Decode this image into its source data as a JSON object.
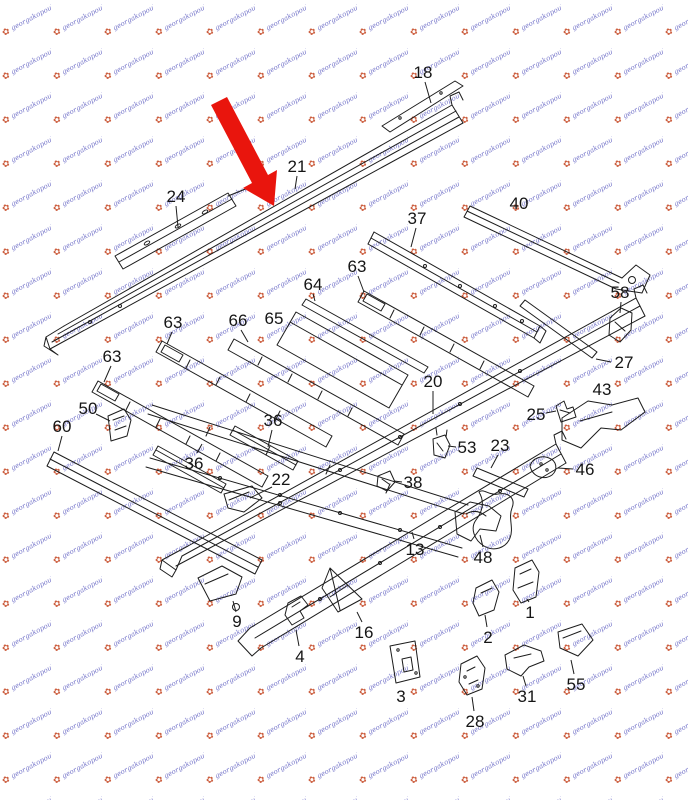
{
  "watermark": {
    "text": "georgakopoulos",
    "logo_glyph": "✿",
    "text_color": "#5a5ac0",
    "logo_color": "#c8502e"
  },
  "arrow": {
    "color": "#e9150d",
    "target_part": "21"
  },
  "diagram": {
    "line_color": "#1c1c1c",
    "label_color": "#151515",
    "parts": [
      {
        "label": "18",
        "x": 423,
        "y": 72,
        "leader": [
          425,
          82,
          431,
          103
        ]
      },
      {
        "label": "21",
        "x": 297,
        "y": 166,
        "leader": [
          297,
          176,
          295,
          189
        ]
      },
      {
        "label": "24",
        "x": 176,
        "y": 196,
        "leader": [
          176,
          206,
          178,
          227
        ]
      },
      {
        "label": "37",
        "x": 417,
        "y": 218,
        "leader": [
          416,
          228,
          411,
          247
        ]
      },
      {
        "label": "40",
        "x": 519,
        "y": 203,
        "leader": null
      },
      {
        "label": "58",
        "x": 620,
        "y": 292,
        "leader": [
          621,
          302,
          620,
          313
        ]
      },
      {
        "label": "63",
        "x": 173,
        "y": 322,
        "leader": [
          172,
          332,
          167,
          344
        ]
      },
      {
        "label": "63",
        "x": 112,
        "y": 356,
        "leader": [
          111,
          366,
          104,
          382
        ]
      },
      {
        "label": "63",
        "x": 357,
        "y": 266,
        "leader": [
          358,
          276,
          364,
          292
        ]
      },
      {
        "label": "64",
        "x": 313,
        "y": 284,
        "leader": [
          313,
          294,
          315,
          301
        ]
      },
      {
        "label": "65",
        "x": 274,
        "y": 318,
        "leader": null
      },
      {
        "label": "66",
        "x": 238,
        "y": 320,
        "leader": [
          241,
          330,
          248,
          342
        ]
      },
      {
        "label": "20",
        "x": 433,
        "y": 381,
        "leader": [
          433,
          391,
          433,
          414
        ]
      },
      {
        "label": "27",
        "x": 624,
        "y": 362,
        "leader": [
          611,
          362,
          596,
          359
        ]
      },
      {
        "label": "43",
        "x": 602,
        "y": 389,
        "leader": null
      },
      {
        "label": "25",
        "x": 536,
        "y": 414,
        "leader": [
          546,
          413,
          556,
          411
        ]
      },
      {
        "label": "23",
        "x": 500,
        "y": 445,
        "leader": [
          498,
          455,
          491,
          468
        ]
      },
      {
        "label": "53",
        "x": 467,
        "y": 447,
        "leader": [
          456,
          447,
          448,
          446
        ]
      },
      {
        "label": "46",
        "x": 585,
        "y": 469,
        "leader": [
          573,
          469,
          558,
          468
        ]
      },
      {
        "label": "38",
        "x": 413,
        "y": 482,
        "leader": [
          402,
          482,
          394,
          481
        ]
      },
      {
        "label": "36",
        "x": 273,
        "y": 420,
        "leader": [
          272,
          430,
          268,
          447
        ]
      },
      {
        "label": "36",
        "x": 194,
        "y": 463,
        "leader": [
          197,
          453,
          202,
          444
        ]
      },
      {
        "label": "22",
        "x": 281,
        "y": 479,
        "leader": [
          272,
          487,
          250,
          498
        ]
      },
      {
        "label": "50",
        "x": 88,
        "y": 408,
        "leader": [
          96,
          414,
          110,
          421
        ]
      },
      {
        "label": "60",
        "x": 62,
        "y": 426,
        "leader": [
          62,
          436,
          58,
          451
        ]
      },
      {
        "label": "13",
        "x": 415,
        "y": 549,
        "leader": [
          414,
          539,
          412,
          532
        ]
      },
      {
        "label": "48",
        "x": 483,
        "y": 557,
        "leader": [
          483,
          547,
          480,
          535
        ]
      },
      {
        "label": "9",
        "x": 237,
        "y": 621,
        "leader": [
          236,
          612,
          233,
          601
        ]
      },
      {
        "label": "16",
        "x": 364,
        "y": 632,
        "leader": [
          362,
          622,
          357,
          612
        ]
      },
      {
        "label": "4",
        "x": 300,
        "y": 656,
        "leader": [
          299,
          646,
          296,
          630
        ]
      },
      {
        "label": "3",
        "x": 401,
        "y": 696,
        "leader": null
      },
      {
        "label": "28",
        "x": 475,
        "y": 721,
        "leader": [
          474,
          711,
          472,
          697
        ]
      },
      {
        "label": "31",
        "x": 527,
        "y": 696,
        "leader": [
          526,
          686,
          523,
          676
        ]
      },
      {
        "label": "55",
        "x": 576,
        "y": 684,
        "leader": [
          574,
          674,
          571,
          660
        ]
      },
      {
        "label": "1",
        "x": 530,
        "y": 612,
        "leader": [
          529,
          602,
          527,
          599
        ]
      },
      {
        "label": "2",
        "x": 488,
        "y": 637,
        "leader": [
          487,
          627,
          485,
          615
        ]
      }
    ]
  }
}
